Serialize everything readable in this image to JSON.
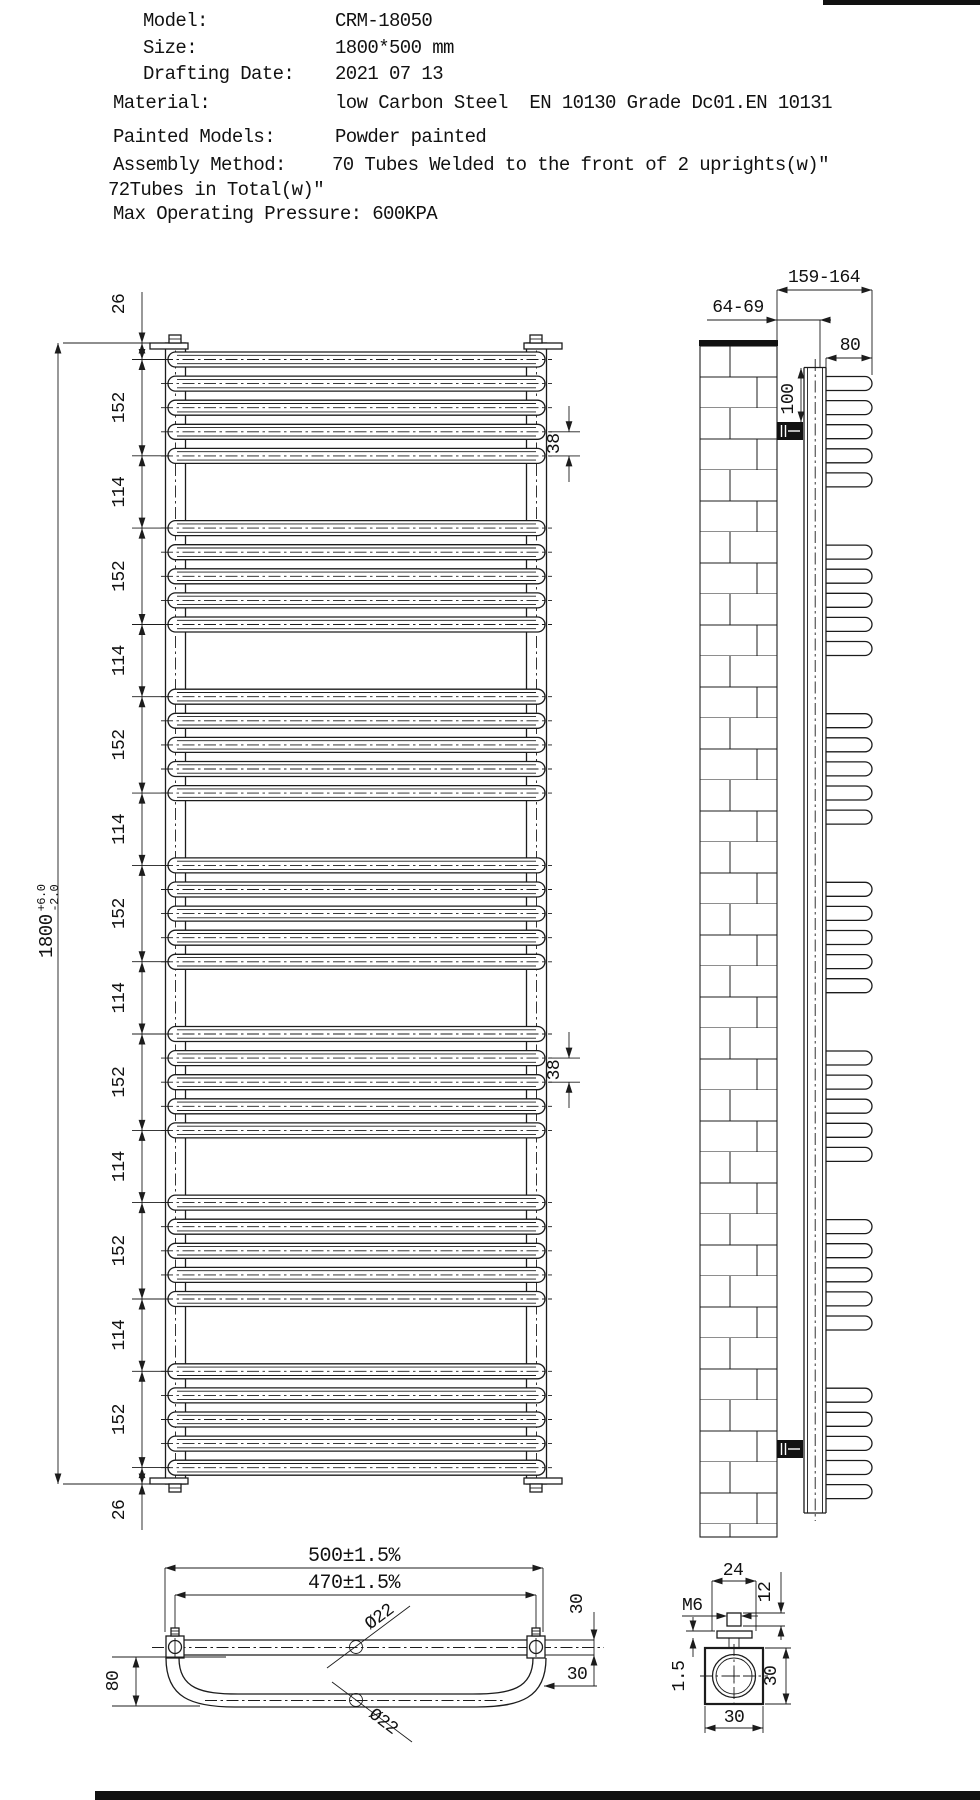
{
  "header": {
    "rows": [
      {
        "label": "Model:",
        "value": "CRM-18050"
      },
      {
        "label": "Size:",
        "value": "1800*500 mm"
      },
      {
        "label": "Drafting Date:",
        "value": "2021 07 13"
      },
      {
        "label": "Material:",
        "value": "low Carbon Steel  EN 10130 Grade Dc01.EN 10131"
      },
      {
        "label": "Painted Models:",
        "value": "Powder painted"
      },
      {
        "label": "Assembly Method:",
        "value": "70 Tubes Welded to the front of 2 uprights(w)″"
      },
      {
        "label": "72Tubes in Total(w)″",
        "value": ""
      },
      {
        "label": "Max Operating Pressure: 600KPA",
        "value": ""
      }
    ]
  },
  "front_view": {
    "overall": "1800",
    "tol_plus": "+6.0",
    "tol_minus": "-2.0",
    "pitch_a": "38",
    "pitch_b": "38",
    "chain": [
      "26",
      "152",
      "114",
      "152",
      "114",
      "152",
      "114",
      "152",
      "114",
      "152",
      "114",
      "152",
      "114",
      "152",
      "26"
    ]
  },
  "side_view": {
    "wall_offset": "64-69",
    "overall_depth": "159-164",
    "tube_depth": "80",
    "bracket_drop": "100"
  },
  "bottom_view": {
    "overall_width": "500±1.5%",
    "hole_centers": "470±1.5%",
    "tube_dia_top": "Ø22",
    "tube_dia_loop": "Ø22",
    "loop_depth": "80",
    "end_height": "30",
    "end_offset": "30"
  },
  "detail_view": {
    "top_width": "24",
    "stud_height": "12",
    "thread": "M6",
    "plate_thickness": "1.5",
    "block_height": "30",
    "block_width": "30"
  }
}
